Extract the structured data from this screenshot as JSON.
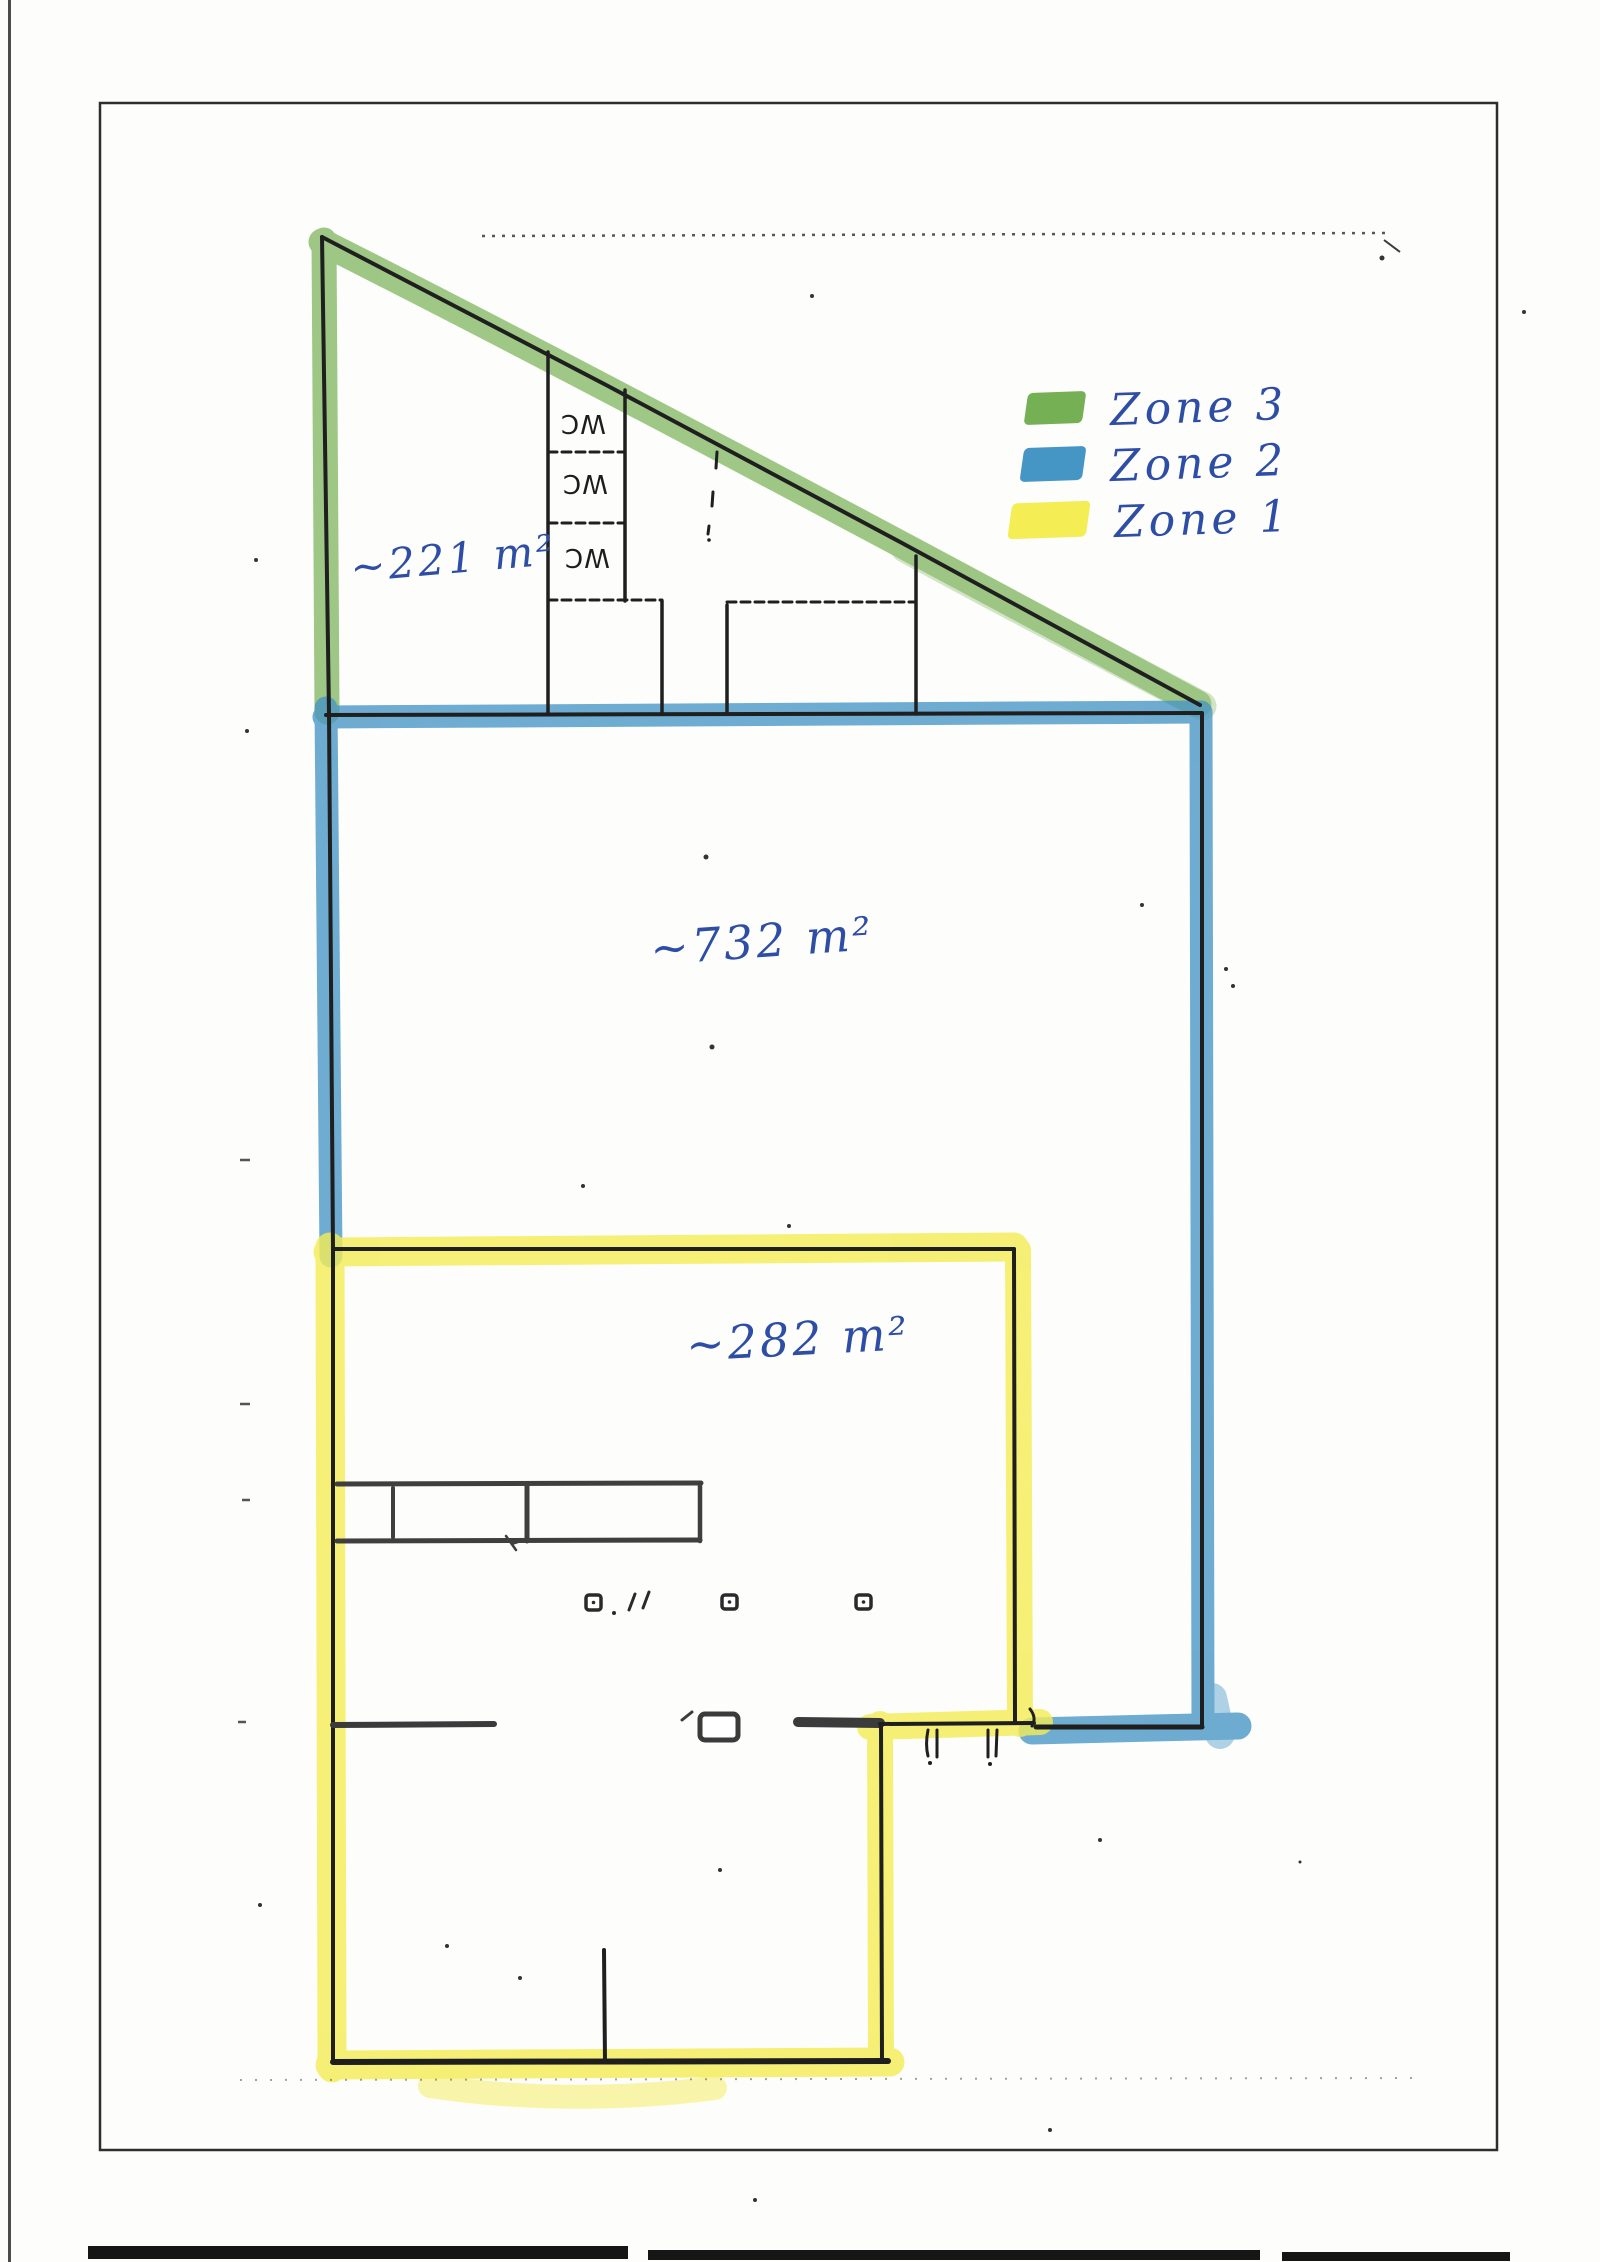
{
  "legend": {
    "items": [
      {
        "label": "Zone 3",
        "color": "#76b054"
      },
      {
        "label": "Zone 2",
        "color": "#4595c5"
      },
      {
        "label": "Zone 1",
        "color": "#f4ee54"
      }
    ]
  },
  "annotations": {
    "zone3_area": "~221 m²",
    "zone2_area": "~732 m²",
    "zone1_area": "~282 m²"
  },
  "plan": {
    "wc_labels": [
      "WC",
      "WC",
      "WC"
    ]
  },
  "colors": {
    "highlight_green": "#76b054",
    "highlight_blue": "#4595c5",
    "highlight_yellow": "#f4ee54",
    "ink": "#2e4da5",
    "wall": "#222222"
  }
}
